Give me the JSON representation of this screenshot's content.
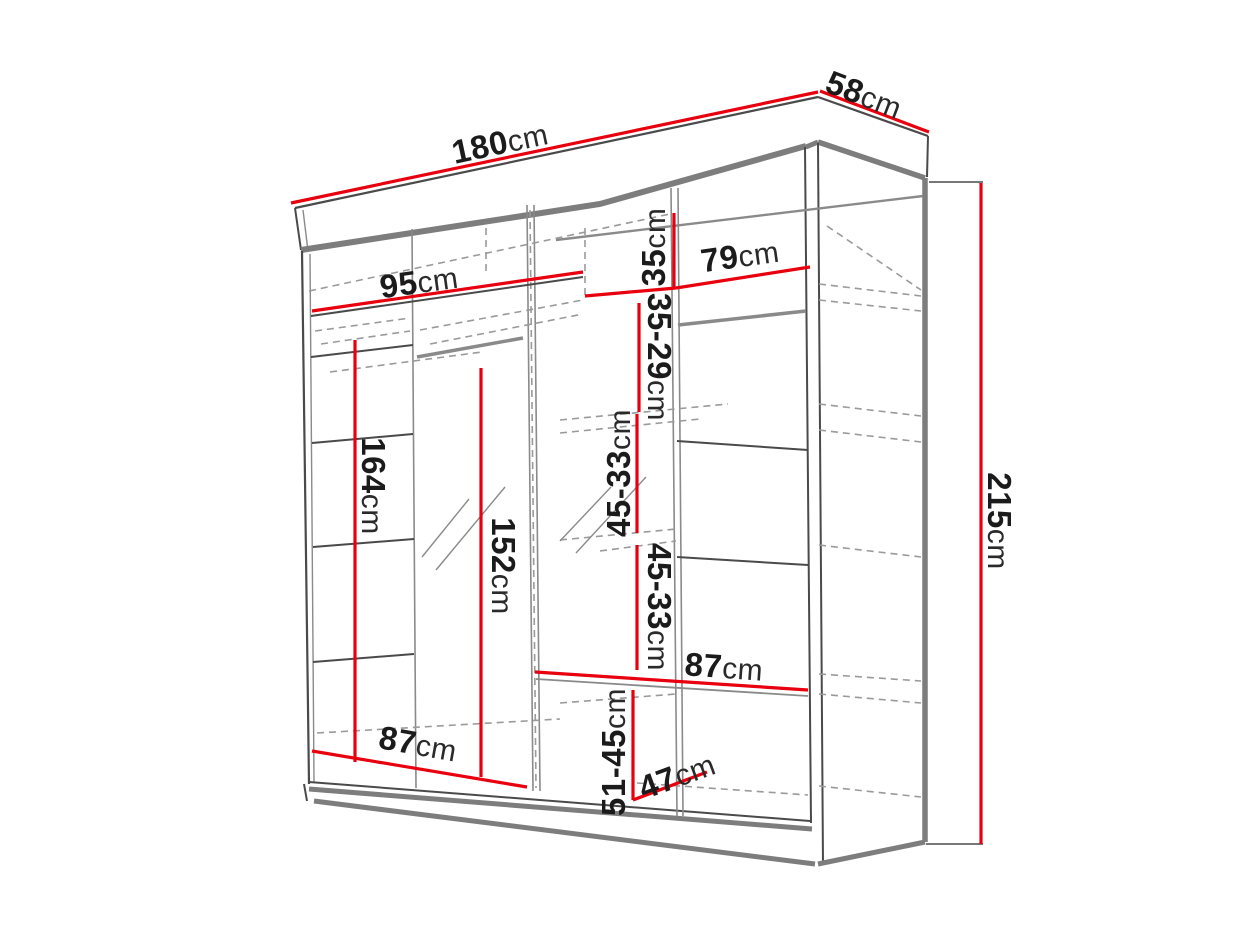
{
  "diagram": {
    "type": "wardrobe-dimension-drawing",
    "unit": "cm",
    "colors": {
      "dimension_line": "#e8000e",
      "structure_dark": "#4a4a4a",
      "structure_gray": "#7d7d7d",
      "hidden_edge": "#9a9a9a",
      "text": "#1b1b1b",
      "background": "#ffffff"
    },
    "overall": {
      "width": "180cm",
      "depth": "58cm",
      "height": "215cm"
    },
    "labels": {
      "w180": {
        "num": "180",
        "unit": "cm"
      },
      "d58": {
        "num": "58",
        "unit": "cm"
      },
      "h215": {
        "num": "215",
        "unit": "cm"
      },
      "w95": {
        "num": "95",
        "unit": "cm"
      },
      "w79": {
        "num": "79",
        "unit": "cm"
      },
      "h35": {
        "num": "35",
        "unit": "cm"
      },
      "h3529": {
        "num": "35-29",
        "unit": "cm"
      },
      "h4533a": {
        "num": "45-33",
        "unit": "cm"
      },
      "h4533b": {
        "num": "45-33",
        "unit": "cm"
      },
      "w87r": {
        "num": "87",
        "unit": "cm"
      },
      "h5145": {
        "num": "51-45",
        "unit": "cm"
      },
      "d47": {
        "num": "47",
        "unit": "cm"
      },
      "w87l": {
        "num": "87",
        "unit": "cm"
      },
      "h164": {
        "num": "164",
        "unit": "cm"
      },
      "h152": {
        "num": "152",
        "unit": "cm"
      }
    },
    "measurements": [
      {
        "value": "180",
        "unit": "cm",
        "axis": "width",
        "location": "top front edge"
      },
      {
        "value": "58",
        "unit": "cm",
        "axis": "depth",
        "location": "top right edge"
      },
      {
        "value": "215",
        "unit": "cm",
        "axis": "height",
        "location": "right side bracket"
      },
      {
        "value": "95",
        "unit": "cm",
        "axis": "width",
        "location": "upper left interior shelf"
      },
      {
        "value": "79",
        "unit": "cm",
        "axis": "width",
        "location": "upper right interior shelf"
      },
      {
        "value": "35",
        "unit": "cm",
        "axis": "height",
        "location": "top center compartment"
      },
      {
        "value": "35-29",
        "unit": "cm",
        "axis": "height",
        "location": "center compartment 1"
      },
      {
        "value": "45-33",
        "unit": "cm",
        "axis": "height",
        "location": "center compartment 2"
      },
      {
        "value": "45-33",
        "unit": "cm",
        "axis": "height",
        "location": "center compartment 3"
      },
      {
        "value": "87",
        "unit": "cm",
        "axis": "width",
        "location": "right half shelf"
      },
      {
        "value": "51-45",
        "unit": "cm",
        "axis": "height",
        "location": "bottom center compartment"
      },
      {
        "value": "47",
        "unit": "cm",
        "axis": "depth",
        "location": "bottom right floor"
      },
      {
        "value": "87",
        "unit": "cm",
        "axis": "width",
        "location": "bottom left floor"
      },
      {
        "value": "164",
        "unit": "cm",
        "axis": "height",
        "location": "left shelf column interior"
      },
      {
        "value": "152",
        "unit": "cm",
        "axis": "height",
        "location": "left mirror section interior"
      }
    ]
  }
}
